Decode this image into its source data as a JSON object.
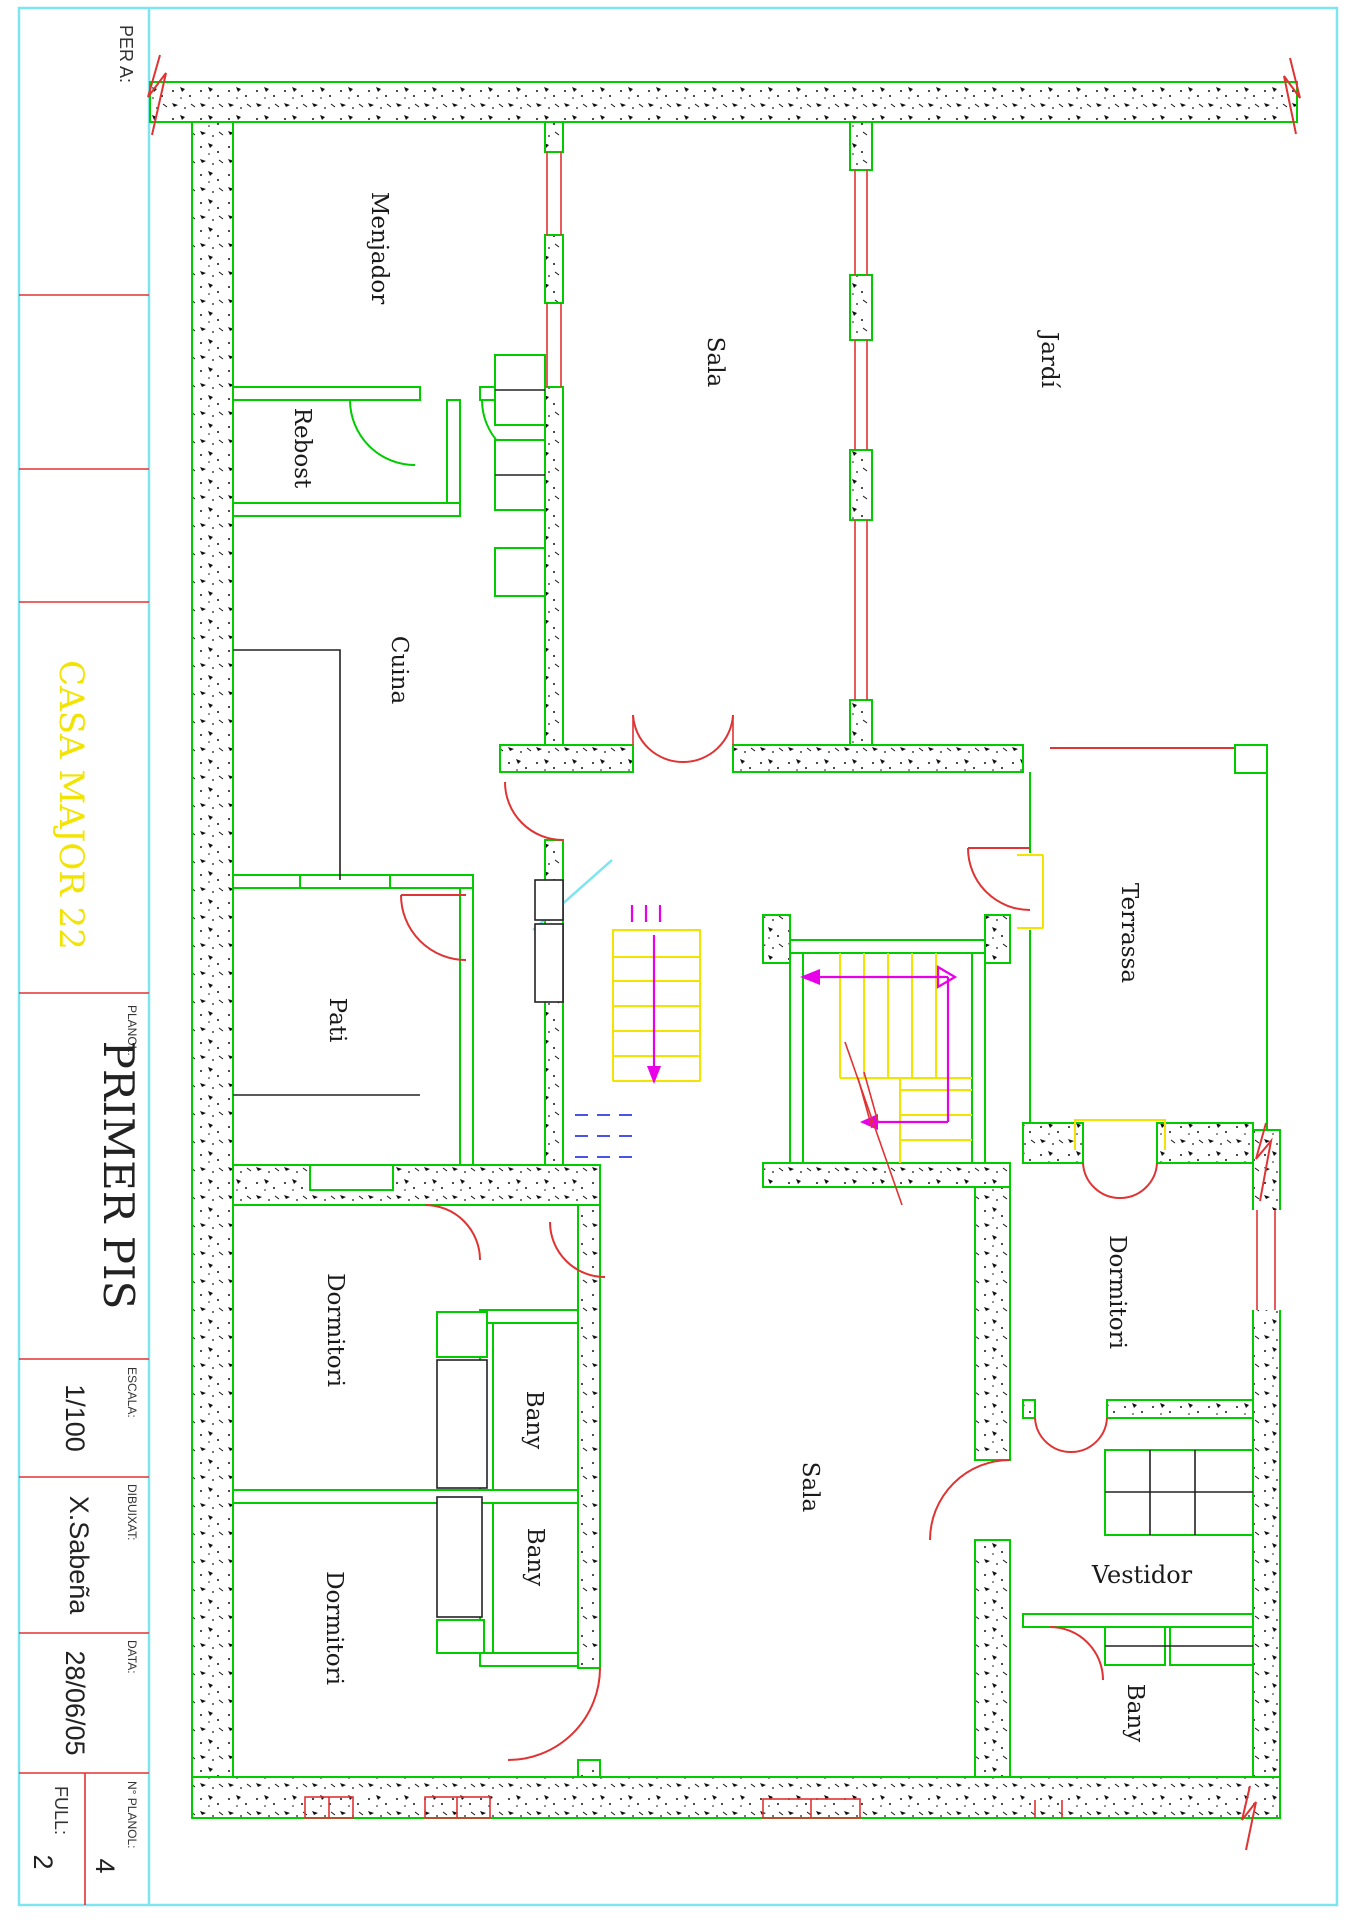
{
  "title_block": {
    "per_a_label": "PER A:",
    "project_title": "CASA MAJOR 22",
    "planol_label": "PLANOL:",
    "planol_value": "PRIMER PIS",
    "escala_label": "ESCALA:",
    "escala_value": "1/100",
    "dibuixat_label": "DIBUIXAT:",
    "dibuixat_value": "X.Sabeña",
    "data_label": "DATA:",
    "data_value": "28/06/05",
    "num_planol_label": "N° PLANOL:",
    "num_planol_value": "4",
    "full_label": "FULL:",
    "full_value": "2"
  },
  "rooms": {
    "menjador": "Menjador",
    "rebost": "Rebost",
    "cuina": "Cuina",
    "sala_nord": "Sala",
    "jardi": "Jardí",
    "terrassa": "Terrassa",
    "pati": "Pati",
    "dormitori_1": "Dormitori",
    "bany_1": "Bany",
    "bany_2": "Bany",
    "dormitori_2": "Dormitori",
    "sala_sud": "Sala",
    "dormitori_3": "Dormitori",
    "vestidor": "Vestidor",
    "bany_3": "Bany"
  },
  "colors": {
    "wall_green": "#00cc00",
    "line_red": "#e03333",
    "detail_yellow": "#f2e400",
    "arrow_magenta": "#e800e8",
    "border_cyan": "#7de5ef",
    "hidden_blue": "#4b52e8",
    "title_yellow": "#f2e400",
    "ink_black": "#1a1a1a"
  }
}
